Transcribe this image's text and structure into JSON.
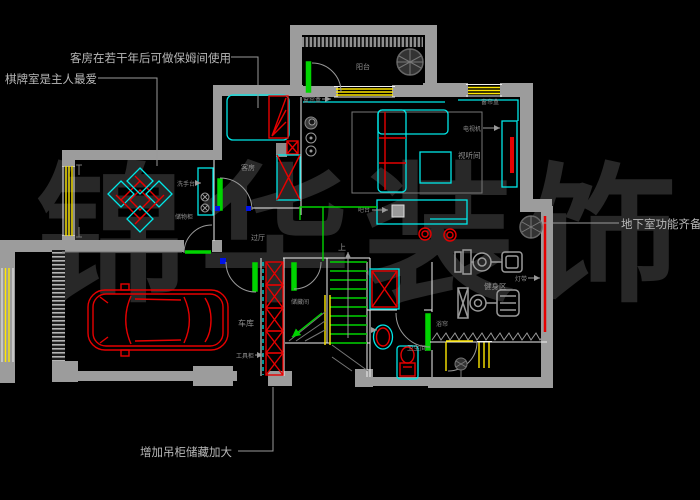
{
  "colors": {
    "background": "#000000",
    "wall": "#9c9c9c",
    "white": "#f0f0f0",
    "cyan": "#00e8e8",
    "red": "#e60000",
    "green": "#00d400",
    "yellow": "#ffe800",
    "blue": "#0012e6",
    "label": "#8f8f8f",
    "annotation": "#b8b8b8",
    "watermark": "#282828",
    "machine": "#9a9a9a"
  },
  "watermark": {
    "text": "锦华装饰"
  },
  "annotations": {
    "guest_room": "客房在若干年后可做保姆间使用",
    "chess_room": "棋牌室是主人最爱",
    "basement": "地下室功能齐备",
    "storage": "增加吊柜储藏加大"
  },
  "rooms": {
    "balcony": "阳台",
    "guest_room": "客房",
    "hall": "过厅",
    "garage": "车库",
    "under_stair_storage": "储藏间",
    "av_room": "视听间",
    "gym": "健身区",
    "bathroom": "卫生间",
    "stairs_up": "上"
  },
  "fixtures": {
    "curtain_box_left": "窗帘盒",
    "curtain_box_right": "窗帘盒",
    "tv": "电视机",
    "bar": "吧台",
    "light_strip": "灯带",
    "shower_curtain": "浴帘",
    "tool_cabinet": "工具柜",
    "wash_stand": "洗手台",
    "storage_cabinet": "储物柜"
  }
}
